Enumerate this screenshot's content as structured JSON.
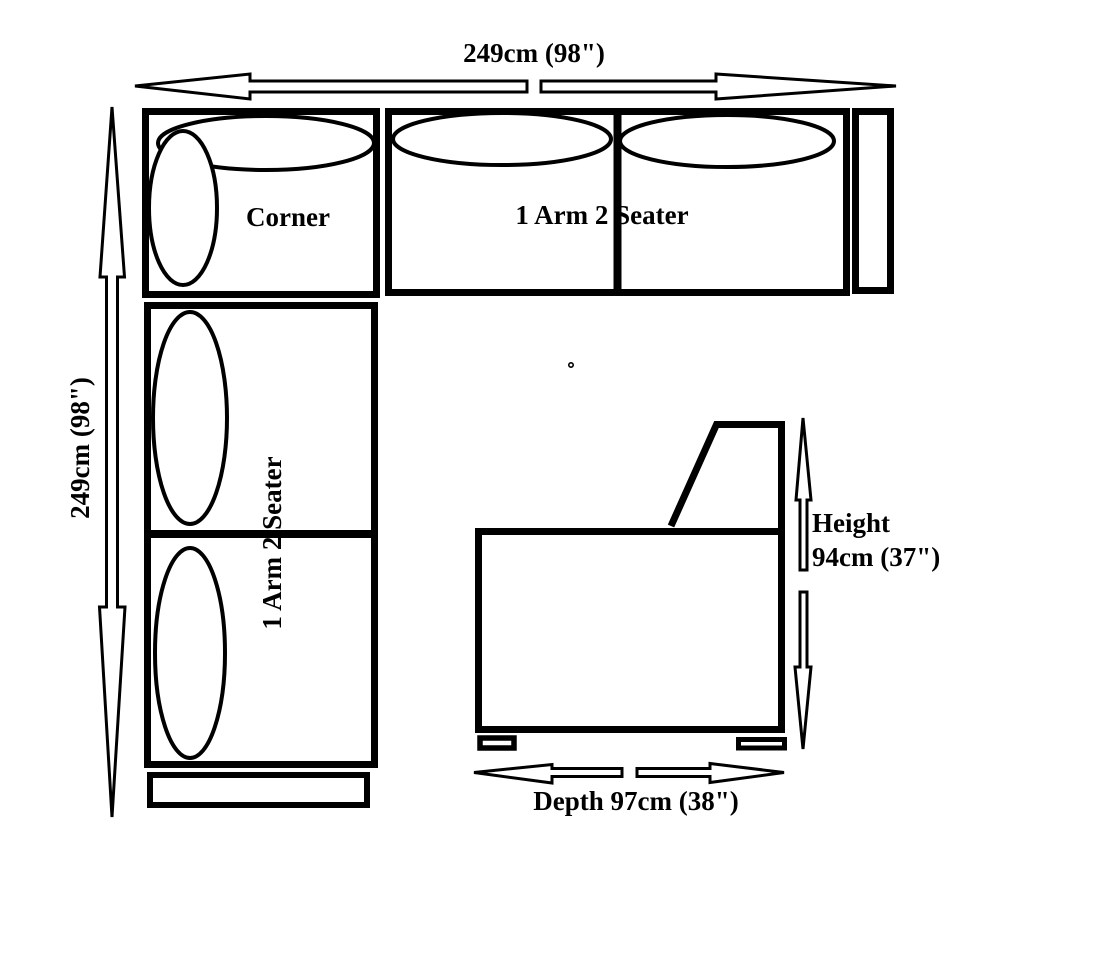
{
  "diagram": {
    "kind": "corner-sofa-dimension-diagram",
    "ink_color": "#000000",
    "background_color": "#ffffff",
    "dimensions": {
      "top_width": "249cm (98\")",
      "left_depth": "249cm (98\")"
    },
    "top_view": {
      "corner_label": "Corner",
      "top_section_label": "1 Arm 2 Seater",
      "left_section_label": "1 Arm 2 Seater"
    },
    "side_view": {
      "height_label": "Height",
      "height_value": "94cm (37\")",
      "depth_label": "Depth 97cm (38\")"
    }
  }
}
